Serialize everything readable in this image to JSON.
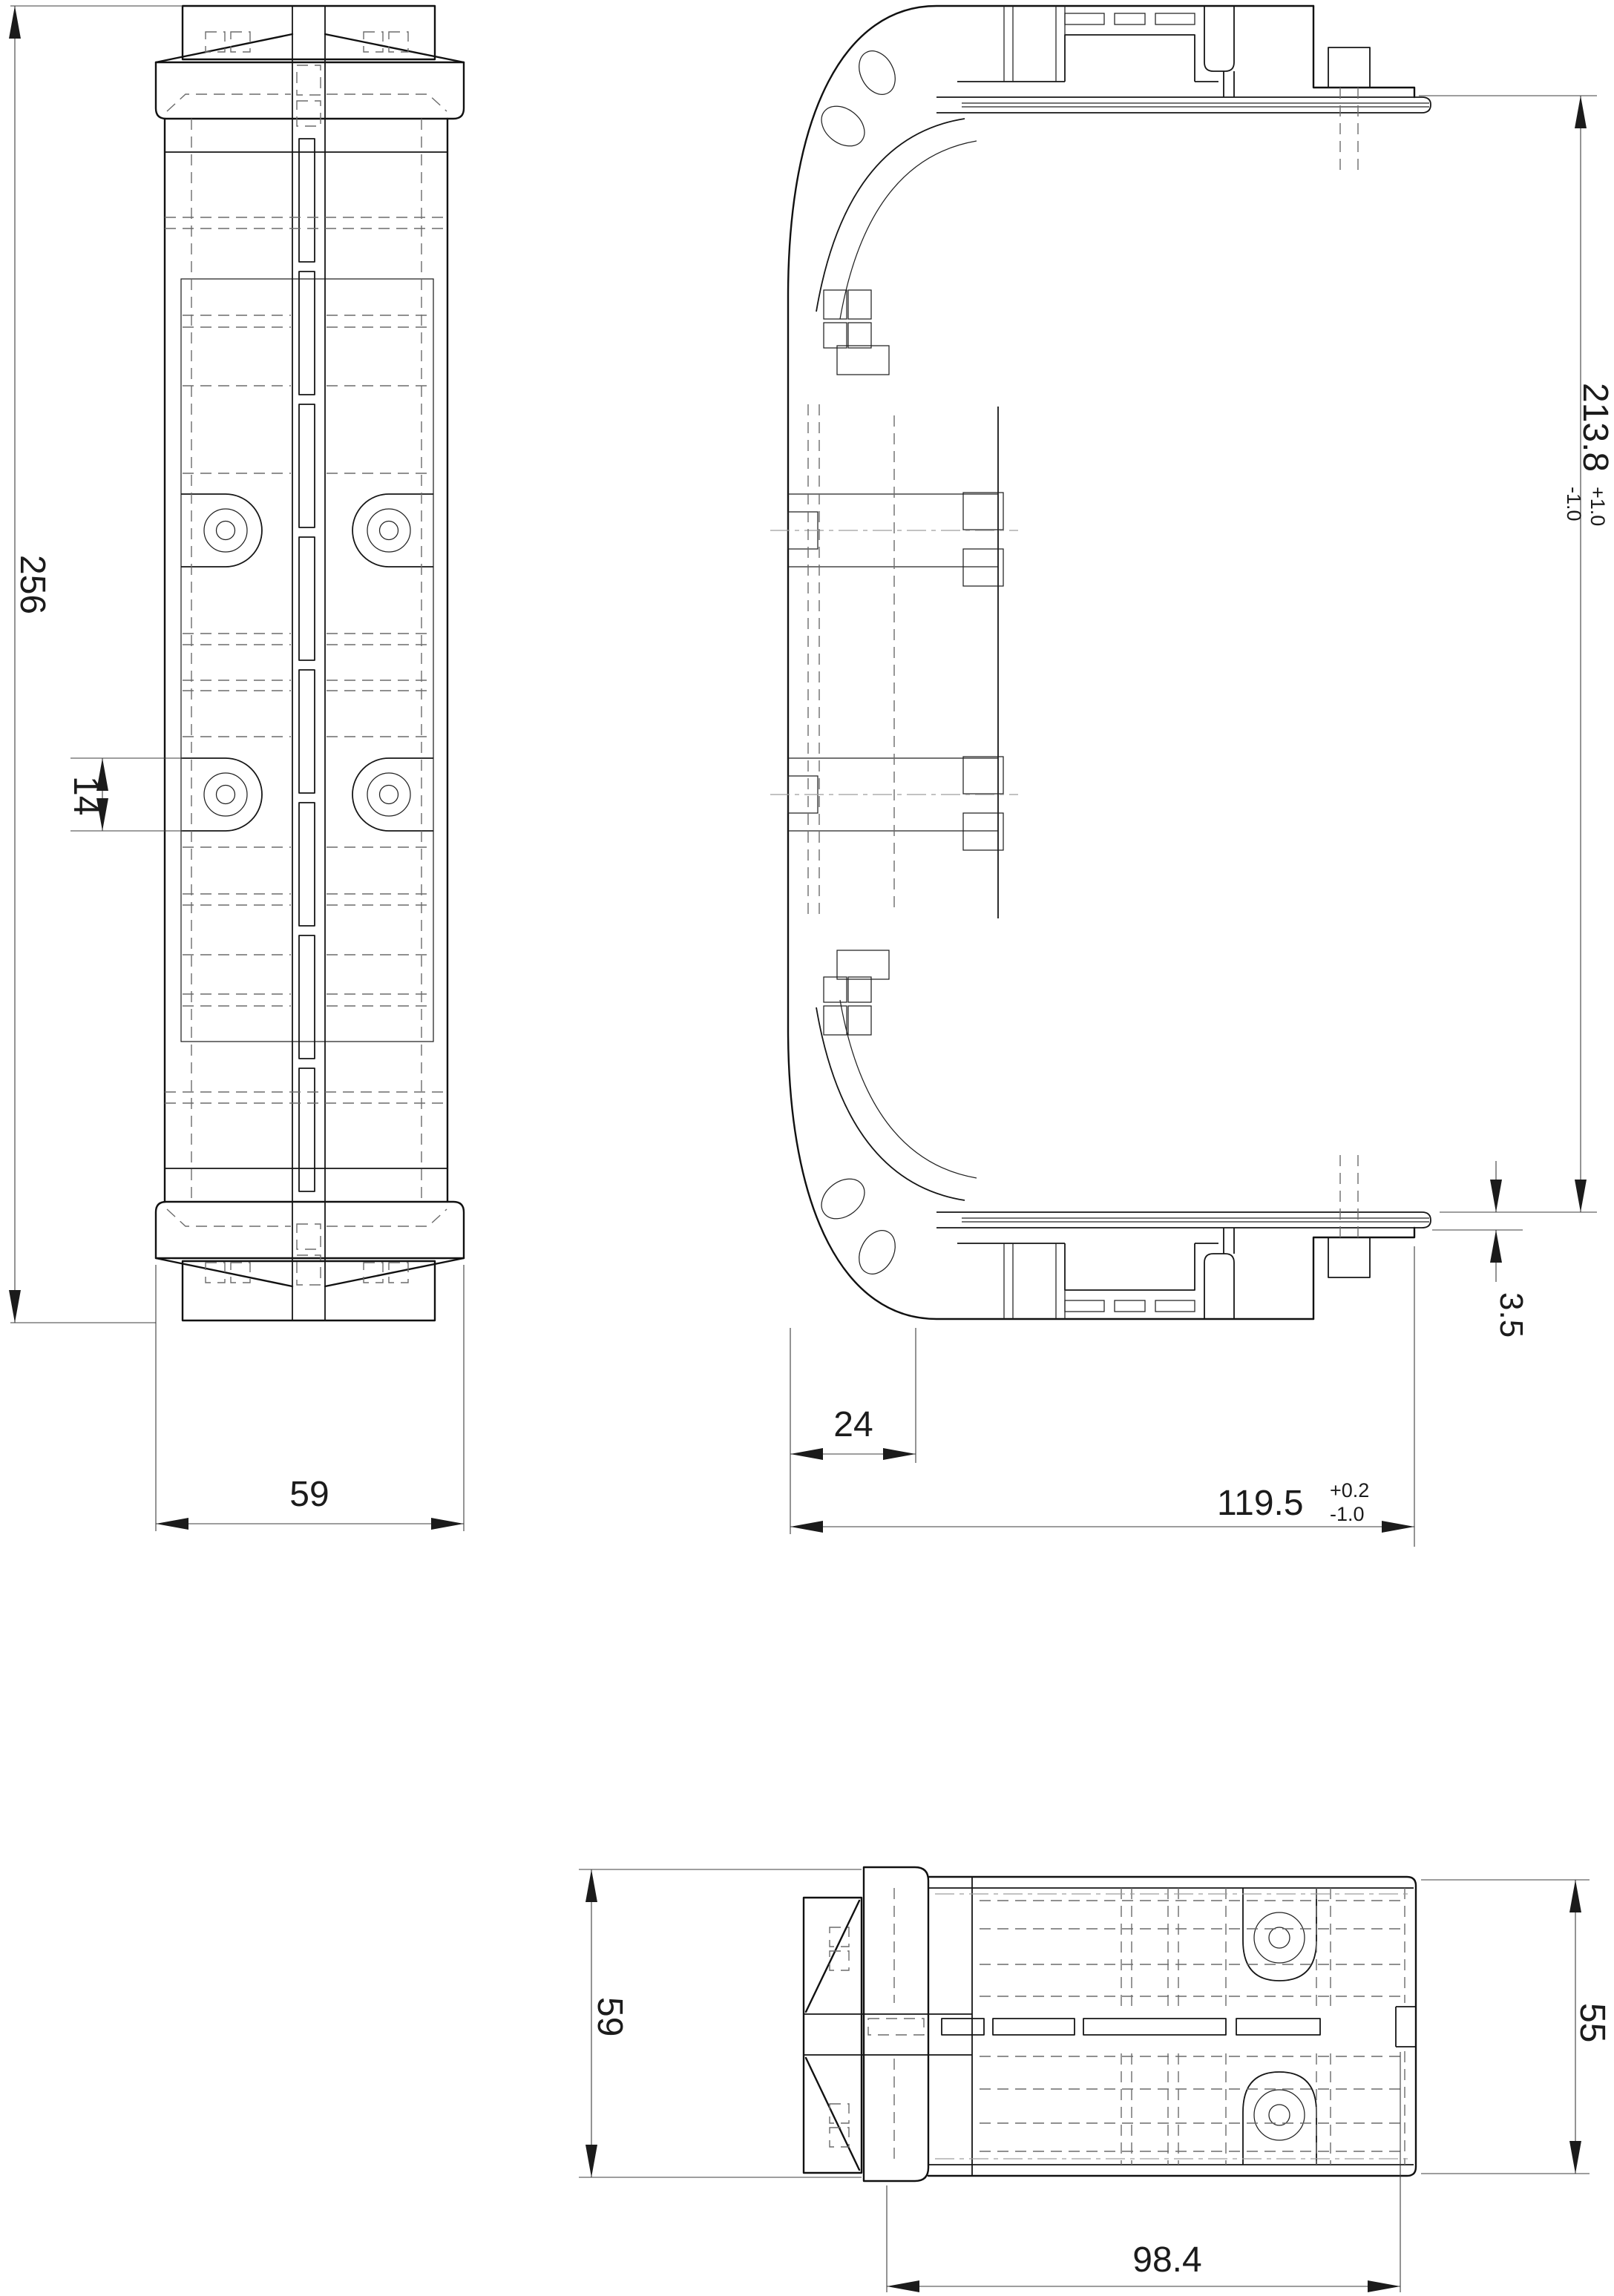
{
  "drawing": {
    "sheet_background": "#ffffff",
    "outline_color": "#111111",
    "hidden_line_color": "#6b6b6b",
    "phantom_line_color": "#9e9e9e",
    "dimension_color": "#3d3d3d",
    "dimensions": {
      "front_height": {
        "value": "256"
      },
      "front_tab_height": {
        "value": "14"
      },
      "front_width": {
        "value": "59"
      },
      "side_flange_width": {
        "value": "24"
      },
      "side_overall_width": {
        "value": "119.5",
        "tol_plus": "+0.2",
        "tol_minus": "-1.0"
      },
      "side_inner_height": {
        "value": "213.8",
        "tol_plus": "+1.0",
        "tol_minus": "-1.0"
      },
      "side_plate_thickness": {
        "value": "3.5"
      },
      "bottom_depth": {
        "value": "59"
      },
      "bottom_right_depth": {
        "value": "55"
      },
      "bottom_width": {
        "value": "98.4"
      }
    }
  }
}
